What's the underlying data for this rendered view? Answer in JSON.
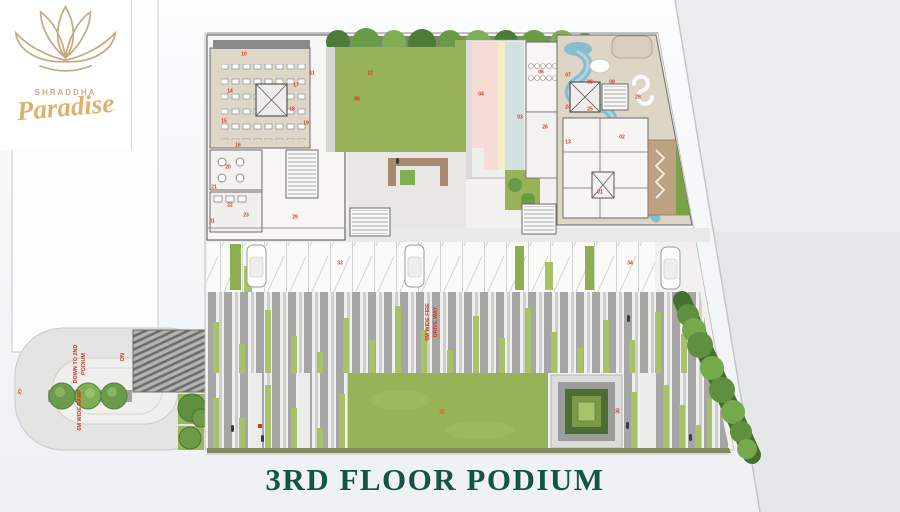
{
  "brand": {
    "name_small": "SHRADDHA",
    "name_script": "Paradise"
  },
  "title": "3RD FLOOR PODIUM",
  "plan": {
    "ramp_label_line1": "DOWN TO 2ND",
    "ramp_label_line2": "PODIUM",
    "ramp_width_label": "6M WIDE RAMP",
    "dn_label": "DN",
    "ramp_number": "27",
    "driveway_label_line1": "6M WIDE FIRE",
    "driveway_label_line2": "DRIVE WAY",
    "lawn_number": "32",
    "maze_number": "30",
    "labels": [
      {
        "t": "01",
        "x": 600,
        "y": 193
      },
      {
        "t": "02",
        "x": 622,
        "y": 138
      },
      {
        "t": "03",
        "x": 520,
        "y": 118
      },
      {
        "t": "04",
        "x": 481,
        "y": 95
      },
      {
        "t": "05",
        "x": 357,
        "y": 100
      },
      {
        "t": "06",
        "x": 541,
        "y": 73
      },
      {
        "t": "07",
        "x": 568,
        "y": 76
      },
      {
        "t": "08",
        "x": 590,
        "y": 83
      },
      {
        "t": "09",
        "x": 612,
        "y": 83
      },
      {
        "t": "10",
        "x": 244,
        "y": 55
      },
      {
        "t": "11",
        "x": 312,
        "y": 74
      },
      {
        "t": "12",
        "x": 370,
        "y": 74
      },
      {
        "t": "13",
        "x": 568,
        "y": 143
      },
      {
        "t": "14",
        "x": 230,
        "y": 92
      },
      {
        "t": "15",
        "x": 224,
        "y": 122
      },
      {
        "t": "16",
        "x": 238,
        "y": 146
      },
      {
        "t": "17",
        "x": 296,
        "y": 86
      },
      {
        "t": "18",
        "x": 292,
        "y": 110
      },
      {
        "t": "19",
        "x": 306,
        "y": 124
      },
      {
        "t": "20",
        "x": 228,
        "y": 168
      },
      {
        "t": "21",
        "x": 214,
        "y": 188
      },
      {
        "t": "22",
        "x": 230,
        "y": 206
      },
      {
        "t": "23",
        "x": 246,
        "y": 216
      },
      {
        "t": "24",
        "x": 568,
        "y": 108
      },
      {
        "t": "25",
        "x": 590,
        "y": 110
      },
      {
        "t": "26",
        "x": 545,
        "y": 128
      },
      {
        "t": "28",
        "x": 638,
        "y": 98
      },
      {
        "t": "29",
        "x": 295,
        "y": 218
      },
      {
        "t": "31",
        "x": 212,
        "y": 222
      },
      {
        "t": "33",
        "x": 340,
        "y": 264
      },
      {
        "t": "34",
        "x": 630,
        "y": 264
      }
    ]
  },
  "colors": {
    "title_green": "#155247",
    "logo_gold": "#c9a87e",
    "annotation_red": "#d23726",
    "lawn_green": "#98b257",
    "water_blue": "#8abccf",
    "court_pink": "#f6dcd6",
    "court_teal": "#d2e2e0",
    "court_yellow": "#f4eec8",
    "deck_beige": "#ddd5c6"
  }
}
